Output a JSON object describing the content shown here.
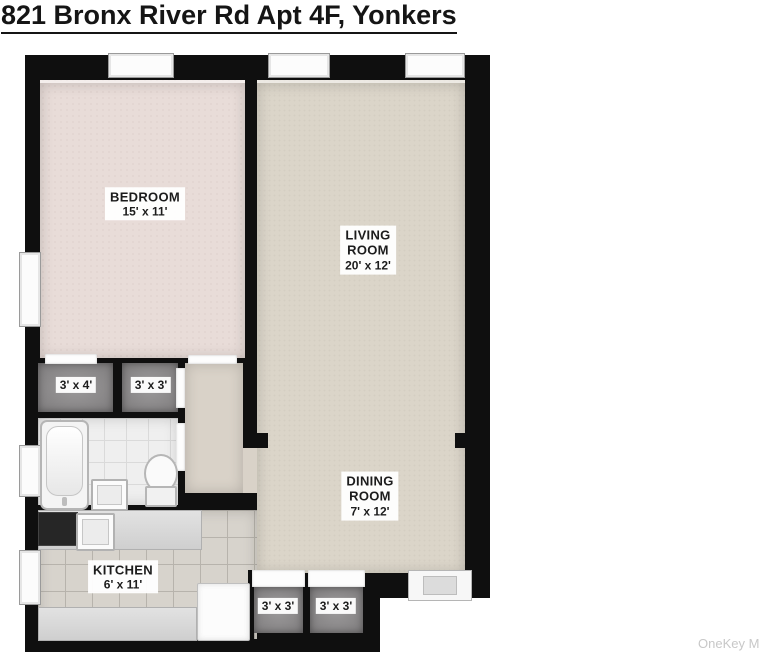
{
  "title": "821 Bronx River Rd Apt 4F, Yonkers",
  "watermark": "OneKey MLS",
  "rooms": {
    "bedroom": {
      "name": "BEDROOM",
      "dims": "15' x 11'"
    },
    "living": {
      "line1": "LIVING",
      "line2": "ROOM",
      "dims": "20' x 12'"
    },
    "dining": {
      "line1": "DINING",
      "line2": "ROOM",
      "dims": "7' x 12'"
    },
    "kitchen": {
      "name": "KITCHEN",
      "dims": "6' x 11'"
    },
    "closet_top_left": {
      "dims": "3' x 4'"
    },
    "closet_top_right": {
      "dims": "3' x 3'"
    },
    "closet_bottom_left": {
      "dims": "3' x 3'"
    },
    "closet_bottom_right": {
      "dims": "3' x 3'"
    }
  },
  "colors": {
    "wall": "#0f0f0f",
    "bedroom_floor": "#e8dcd8",
    "living_floor": "#dbd5c9",
    "closet_floor": "#8e8c8d",
    "bathroom_floor": "#efefef",
    "kitchen_floor": "#d7d3cc",
    "label_background": "#ffffff",
    "watermark_color": "#c8c8c8"
  }
}
